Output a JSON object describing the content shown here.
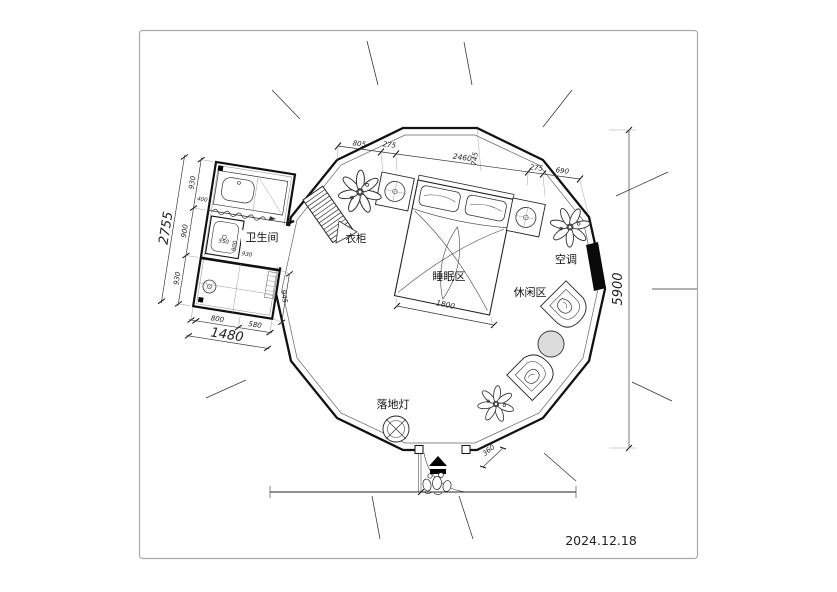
{
  "page": {
    "date": "2024.12.18"
  },
  "labels": {
    "bathroom": "卫生间",
    "wardrobe": "衣柜",
    "sleeping_area": "睡眠区",
    "leisure_area": "休闲区",
    "air_conditioner": "空调",
    "floor_lamp": "落地灯"
  },
  "dims": {
    "top_chain": [
      "805",
      "275",
      "2460",
      "275",
      "690"
    ],
    "top_depth": "745",
    "left_chain": [
      "930",
      "900",
      "930"
    ],
    "left_total": "2755",
    "bath_bottom_chain": [
      "800",
      "580"
    ],
    "bath_bottom_total": "1480",
    "bath_right": "945",
    "shower_width": "550",
    "basin_width": "400",
    "bath_inner_width": "930",
    "bath_inner_depth": "900",
    "bed_width": "1800",
    "plan_diameter": "5900",
    "entrance_offset": "360"
  }
}
